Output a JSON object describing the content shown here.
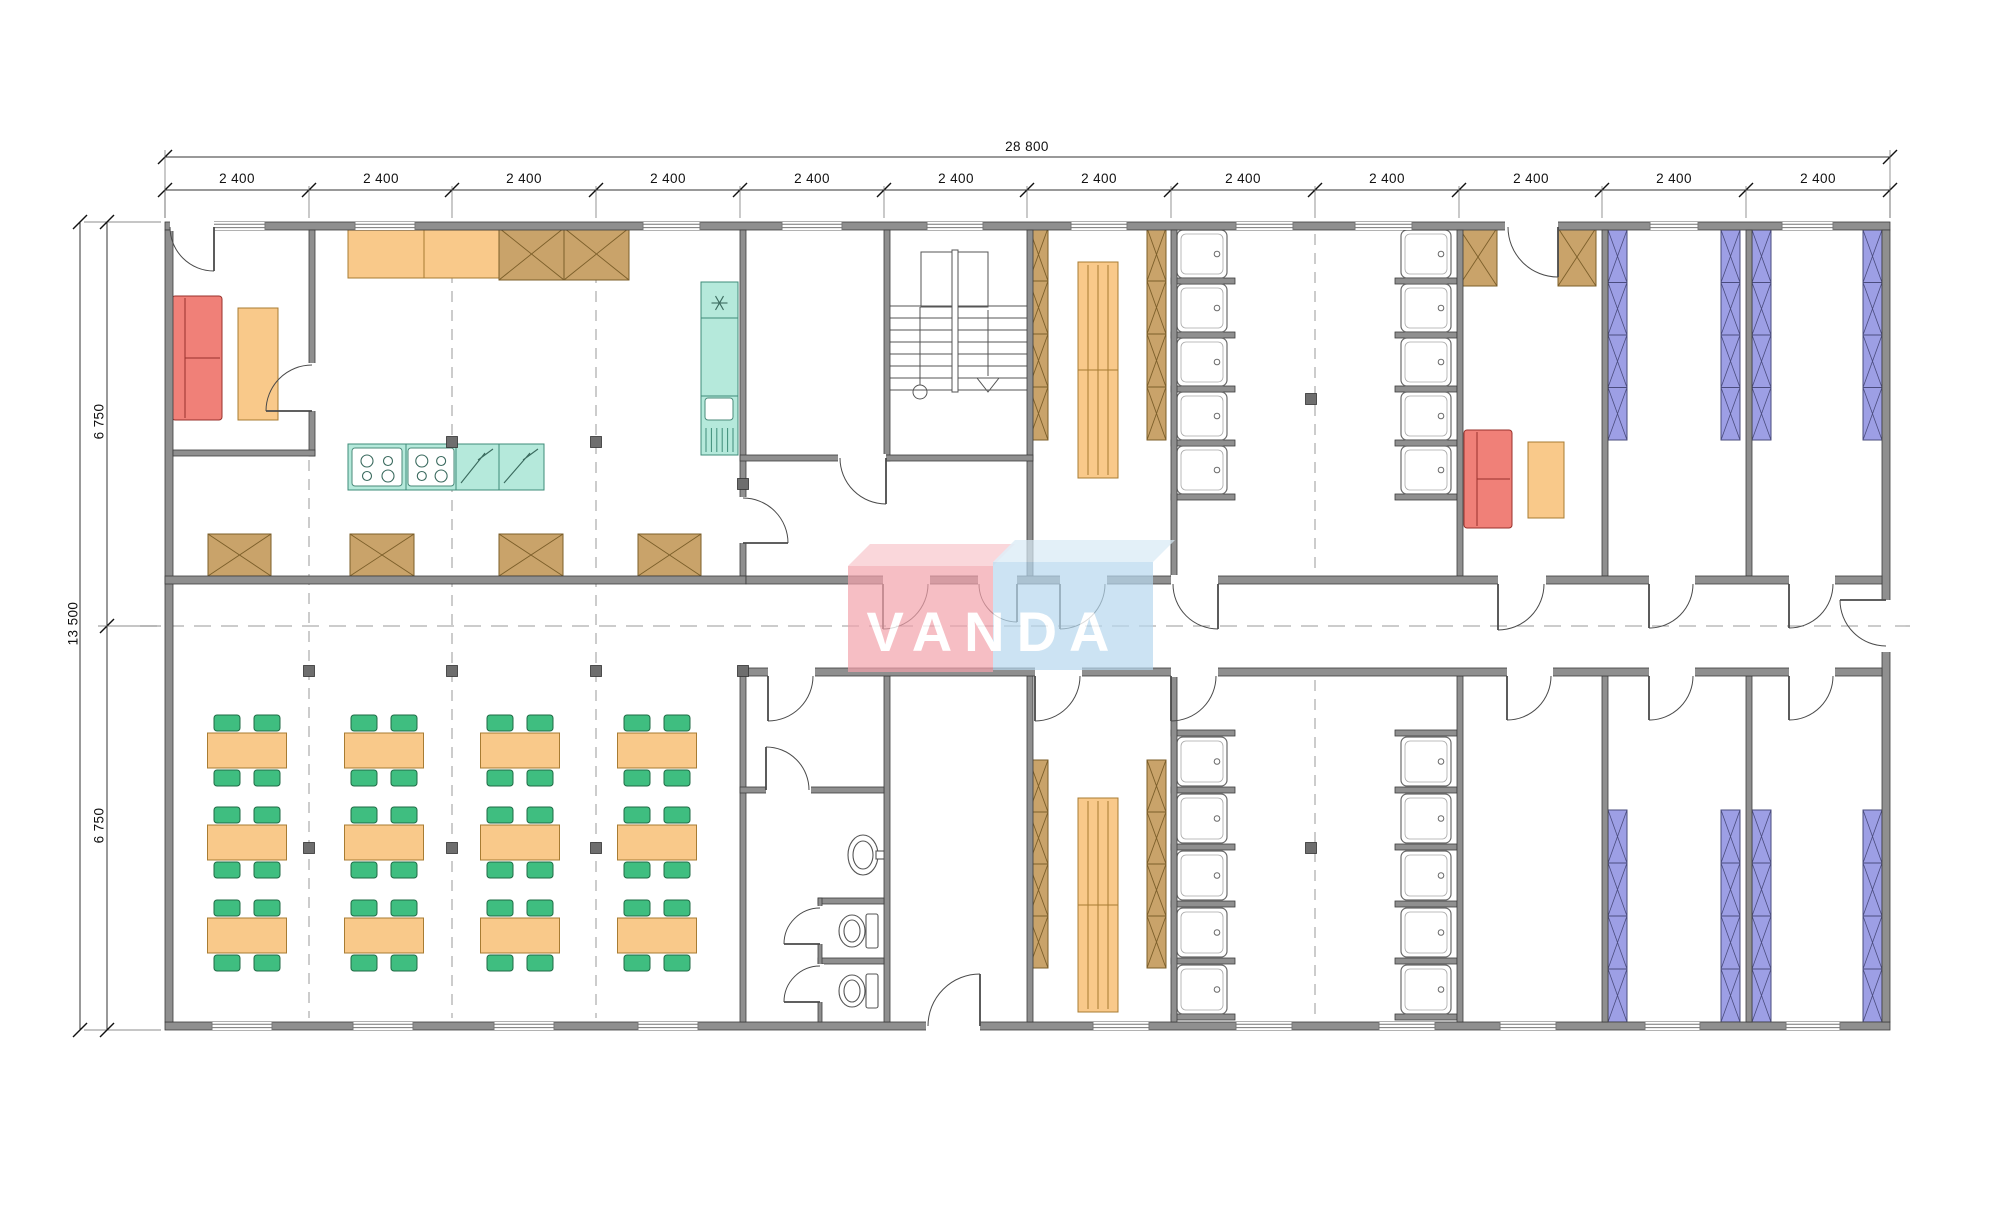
{
  "dimensions": {
    "total_width": "28 800",
    "module_width": "2 400",
    "module_count": 12,
    "total_height": "13 500",
    "half_height": "6 750"
  },
  "watermark": {
    "text": "VANDA"
  },
  "colors": {
    "wall": "#8f8f8f",
    "wall_edge": "#3c3c3c",
    "orange": "#F9C98A",
    "orange_edge": "#A87C33",
    "green": "#3FBE80",
    "green_edge": "#1F6B45",
    "brown": "#C9A36A",
    "brown_edge": "#7C5F2A",
    "blue": "#9D9FE5",
    "blue_edge": "#4A4C7E",
    "teal": "#B5E9DB",
    "teal_edge": "#3E8C78",
    "red": "#F08078",
    "red_edge": "#99312B",
    "post": "#6E6E6E",
    "watermark_red": "#F2A3AC",
    "watermark_red_top": "#F8C7CD",
    "watermark_blue": "#B7D8EE",
    "watermark_blue_top": "#D8EAF6"
  },
  "plan": {
    "module_centers": [
      237,
      381,
      524,
      668,
      812,
      956,
      1099,
      1243,
      1387,
      1531,
      1674,
      1818
    ],
    "module_bounds": [
      165,
      309,
      452,
      596,
      740,
      884,
      1027,
      1171,
      1315,
      1459,
      1602,
      1746,
      1890
    ],
    "walls": [
      [
        165,
        222,
        1725,
        8
      ],
      [
        165,
        1022,
        1725,
        8
      ],
      [
        165,
        230,
        8,
        792
      ],
      [
        1882,
        230,
        8,
        792
      ],
      [
        309,
        230,
        6,
        226
      ],
      [
        173,
        450,
        142,
        6
      ],
      [
        740,
        230,
        6,
        346
      ],
      [
        740,
        668,
        6,
        354
      ],
      [
        884,
        230,
        6,
        231
      ],
      [
        884,
        676,
        6,
        346
      ],
      [
        1027,
        230,
        6,
        346
      ],
      [
        1027,
        676,
        6,
        346
      ],
      [
        1171,
        230,
        6,
        346
      ],
      [
        1171,
        676,
        6,
        346
      ],
      [
        1457,
        230,
        6,
        346
      ],
      [
        1457,
        676,
        6,
        346
      ],
      [
        1602,
        230,
        6,
        346
      ],
      [
        1602,
        676,
        6,
        346
      ],
      [
        1746,
        230,
        6,
        346
      ],
      [
        1746,
        676,
        6,
        346
      ],
      [
        165,
        576,
        581,
        8
      ],
      [
        740,
        455,
        293,
        6
      ],
      [
        746,
        576,
        1136,
        8
      ],
      [
        746,
        668,
        1136,
        8
      ],
      [
        740,
        787,
        144,
        6
      ],
      [
        818,
        898,
        66,
        6
      ],
      [
        818,
        958,
        66,
        6
      ],
      [
        818,
        898,
        4,
        124
      ]
    ],
    "windows": [
      [
        205,
        222,
        60,
        8
      ],
      [
        355,
        222,
        60,
        8
      ],
      [
        643,
        222,
        57,
        8
      ],
      [
        782,
        222,
        60,
        8
      ],
      [
        927,
        222,
        56,
        8
      ],
      [
        1071,
        222,
        56,
        8
      ],
      [
        1236,
        222,
        57,
        8
      ],
      [
        1355,
        222,
        57,
        8
      ],
      [
        1650,
        222,
        48,
        8
      ],
      [
        1782,
        222,
        51,
        8
      ],
      [
        212,
        1022,
        60,
        8
      ],
      [
        353,
        1022,
        60,
        8
      ],
      [
        494,
        1022,
        60,
        8
      ],
      [
        638,
        1022,
        60,
        8
      ],
      [
        1093,
        1022,
        56,
        8
      ],
      [
        1236,
        1022,
        56,
        8
      ],
      [
        1379,
        1022,
        56,
        8
      ],
      [
        1500,
        1022,
        56,
        8
      ],
      [
        1645,
        1022,
        55,
        8
      ],
      [
        1786,
        1022,
        54,
        8
      ]
    ],
    "doors": [
      {
        "g": [
          170,
          221,
          44,
          10
        ],
        "p": [
          214,
          227
        ],
        "r": 44,
        "rot": 180,
        "s": -1
      },
      {
        "g": [
          308,
          363,
          8,
          48
        ],
        "p": [
          312,
          411
        ],
        "r": 46,
        "rot": -90,
        "s": -1
      },
      {
        "g": [
          739,
          497,
          8,
          46
        ],
        "p": [
          743,
          543
        ],
        "r": 45,
        "rot": -90,
        "s": 1
      },
      {
        "g": [
          838,
          454,
          48,
          8
        ],
        "p": [
          886,
          458
        ],
        "r": 46,
        "rot": 180,
        "s": -1
      },
      {
        "g": [
          883,
          575,
          47,
          10
        ],
        "p": [
          883,
          584
        ],
        "r": 45,
        "rot": 0,
        "s": 1
      },
      {
        "g": [
          978,
          575,
          39,
          10
        ],
        "p": [
          1017,
          584
        ],
        "r": 38,
        "rot": 180,
        "s": -1
      },
      {
        "g": [
          1060,
          575,
          47,
          10
        ],
        "p": [
          1060,
          584
        ],
        "r": 45,
        "rot": 0,
        "s": 1
      },
      {
        "g": [
          1171,
          575,
          47,
          10
        ],
        "p": [
          1218,
          584
        ],
        "r": 45,
        "rot": 180,
        "s": -1
      },
      {
        "g": [
          1498,
          575,
          48,
          10
        ],
        "p": [
          1498,
          584
        ],
        "r": 46,
        "rot": 0,
        "s": 1
      },
      {
        "g": [
          1649,
          575,
          46,
          10
        ],
        "p": [
          1649,
          584
        ],
        "r": 44,
        "rot": 0,
        "s": 1
      },
      {
        "g": [
          1789,
          575,
          46,
          10
        ],
        "p": [
          1789,
          584
        ],
        "r": 44,
        "rot": 0,
        "s": 1
      },
      {
        "g": [
          768,
          667,
          47,
          10
        ],
        "p": [
          768,
          676
        ],
        "r": 45,
        "rot": 0,
        "s": 1
      },
      {
        "g": [
          1035,
          667,
          47,
          10
        ],
        "p": [
          1035,
          676
        ],
        "r": 45,
        "rot": 0,
        "s": 1
      },
      {
        "g": [
          1171,
          667,
          47,
          10
        ],
        "p": [
          1171,
          676
        ],
        "r": 45,
        "rot": 0,
        "s": 1
      },
      {
        "g": [
          1507,
          667,
          46,
          10
        ],
        "p": [
          1507,
          676
        ],
        "r": 44,
        "rot": 0,
        "s": 1
      },
      {
        "g": [
          1649,
          667,
          46,
          10
        ],
        "p": [
          1649,
          676
        ],
        "r": 44,
        "rot": 0,
        "s": 1
      },
      {
        "g": [
          1789,
          667,
          46,
          10
        ],
        "p": [
          1789,
          676
        ],
        "r": 44,
        "rot": 0,
        "s": 1
      },
      {
        "g": [
          1881,
          600,
          10,
          52
        ],
        "p": [
          1886,
          600
        ],
        "r": 46,
        "rot": 90,
        "s": 1
      },
      {
        "g": [
          766,
          786,
          45,
          8
        ],
        "p": [
          766,
          790
        ],
        "r": 43,
        "rot": 0,
        "s": -1
      },
      {
        "g": [
          816,
          906,
          8,
          38
        ],
        "p": [
          820,
          944
        ],
        "r": 36,
        "rot": -90,
        "s": -1
      },
      {
        "g": [
          816,
          964,
          8,
          38
        ],
        "p": [
          820,
          1002
        ],
        "r": 36,
        "rot": -90,
        "s": -1
      },
      {
        "g": [
          926,
          1021,
          54,
          10
        ],
        "p": [
          980,
          1026
        ],
        "r": 52,
        "rot": 180,
        "s": 1
      },
      {
        "g": [
          1505,
          221,
          53,
          10
        ],
        "p": [
          1558,
          227
        ],
        "r": 50,
        "rot": 180,
        "s": -1
      }
    ],
    "dash_v": [
      [
        309,
        460,
        1018
      ],
      [
        452,
        234,
        1018
      ],
      [
        596,
        234,
        1018
      ],
      [
        1315,
        234,
        572
      ],
      [
        1315,
        680,
        1018
      ]
    ],
    "centerline": [
      140,
      626,
      1910
    ],
    "posts": [
      [
        452,
        442
      ],
      [
        596,
        442
      ],
      [
        743,
        484
      ],
      [
        1311,
        399
      ],
      [
        309,
        671
      ],
      [
        452,
        671
      ],
      [
        596,
        671
      ],
      [
        743,
        671
      ],
      [
        309,
        848
      ],
      [
        452,
        848
      ],
      [
        596,
        848
      ],
      [
        1311,
        848
      ]
    ],
    "xboxes": [
      {
        "x": 499,
        "y": 228,
        "w": 130,
        "h": 52,
        "cells": 2
      },
      {
        "x": 208,
        "y": 534,
        "w": 63,
        "h": 42,
        "cells": 1
      },
      {
        "x": 350,
        "y": 534,
        "w": 64,
        "h": 42,
        "cells": 1
      },
      {
        "x": 499,
        "y": 534,
        "w": 64,
        "h": 42,
        "cells": 1
      },
      {
        "x": 638,
        "y": 534,
        "w": 63,
        "h": 42,
        "cells": 1
      },
      {
        "x": 1459,
        "y": 228,
        "w": 38,
        "h": 58,
        "cells": 1
      },
      {
        "x": 1558,
        "y": 228,
        "w": 38,
        "h": 58,
        "cells": 1
      }
    ],
    "lockers": [
      [
        1029,
        228,
        19,
        212
      ],
      [
        1147,
        228,
        19,
        212
      ],
      [
        1029,
        760,
        19,
        208
      ],
      [
        1147,
        760,
        19,
        208
      ]
    ],
    "bunks": [
      [
        1608,
        230,
        19,
        210
      ],
      [
        1721,
        230,
        19,
        210
      ],
      [
        1752,
        230,
        19,
        210
      ],
      [
        1863,
        230,
        19,
        210
      ],
      [
        1608,
        810,
        19,
        212
      ],
      [
        1721,
        810,
        19,
        212
      ],
      [
        1752,
        810,
        19,
        212
      ],
      [
        1863,
        810,
        19,
        212
      ]
    ],
    "benches": [
      [
        1078,
        262,
        40,
        216
      ],
      [
        1078,
        798,
        40,
        214
      ]
    ],
    "counter": {
      "x": 348,
      "y": 230,
      "w": 151,
      "h": 48,
      "div": [
        424
      ]
    },
    "island": {
      "x": 348,
      "y": 444,
      "w": 196,
      "h": 46,
      "div": [
        406,
        456,
        499
      ],
      "stoves": [
        [
          352,
          448,
          50,
          38
        ],
        [
          408,
          448,
          46,
          38
        ]
      ],
      "zig": [
        [
          456,
          444,
          43,
          46
        ],
        [
          499,
          444,
          45,
          46
        ]
      ]
    },
    "fridge": {
      "x": 701,
      "y": 282,
      "w": 37,
      "h": 173,
      "div": [
        318,
        396
      ],
      "sink": [
        705,
        398,
        28,
        22
      ],
      "drain": [
        706,
        428,
        27,
        24
      ]
    },
    "sofas": [
      {
        "x": 172,
        "y": 296,
        "w": 50,
        "h": 124,
        "strip": [
          166,
          294,
          6,
          128
        ]
      },
      {
        "x": 1464,
        "y": 430,
        "w": 48,
        "h": 98,
        "strip": [
          0,
          0,
          0,
          0
        ]
      }
    ],
    "small_tables": [
      [
        238,
        308,
        40,
        112
      ],
      [
        1528,
        442,
        36,
        76
      ]
    ],
    "dining": {
      "cx": [
        247,
        384,
        520,
        657
      ],
      "ty": [
        733,
        825,
        918
      ],
      "tw": 79,
      "th": 35,
      "cw": 26,
      "ch": 16
    },
    "showers": {
      "w": 50,
      "cols": [
        {
          "x": 1177,
          "h": 48,
          "ys": [
            230,
            284,
            338,
            392,
            446
          ],
          "stub": [
            1171,
            1235
          ],
          "stub_ys": [
            278,
            332,
            386,
            440,
            494
          ]
        },
        {
          "x": 1401,
          "h": 48,
          "ys": [
            230,
            284,
            338,
            392,
            446
          ],
          "stub": [
            1395,
            1457
          ],
          "stub_ys": [
            278,
            332,
            386,
            440,
            494
          ]
        },
        {
          "x": 1177,
          "h": 49,
          "ys": [
            737,
            794,
            851,
            908,
            965
          ],
          "stub": [
            1171,
            1235
          ],
          "stub_ys": [
            730,
            787,
            844,
            901,
            958,
            1014
          ]
        },
        {
          "x": 1401,
          "h": 49,
          "ys": [
            737,
            794,
            851,
            908,
            965
          ],
          "stub": [
            1395,
            1457
          ],
          "stub_ys": [
            730,
            787,
            844,
            901,
            958,
            1014
          ]
        }
      ]
    },
    "toilets": [
      [
        840,
        912
      ],
      [
        840,
        972
      ]
    ],
    "basin": {
      "cx": 863,
      "cy": 855,
      "rx": 15,
      "ry": 20,
      "tap": [
        876,
        851,
        9,
        8
      ]
    },
    "stairs": {
      "x1": 890,
      "x2": 1027,
      "treads_y": [
        306,
        318,
        330,
        342,
        354,
        366,
        378,
        390
      ],
      "stringer": [
        952,
        250,
        6,
        142
      ],
      "landing": [
        921,
        252,
        67,
        55
      ],
      "circle": [
        920,
        392,
        7
      ],
      "uplines": [
        [
          920,
          307,
          920,
          385
        ],
        [
          988,
          310,
          988,
          376
        ]
      ],
      "arrow": [
        [
          977,
          378
        ],
        [
          988,
          392
        ],
        [
          999,
          378
        ]
      ]
    },
    "dims": {
      "top1_y": 157,
      "top2_y": 190,
      "left1_x": 80,
      "left2_x": 107,
      "plan": [
        165,
        222,
        1890,
        1030
      ],
      "mid_y": 626
    }
  }
}
